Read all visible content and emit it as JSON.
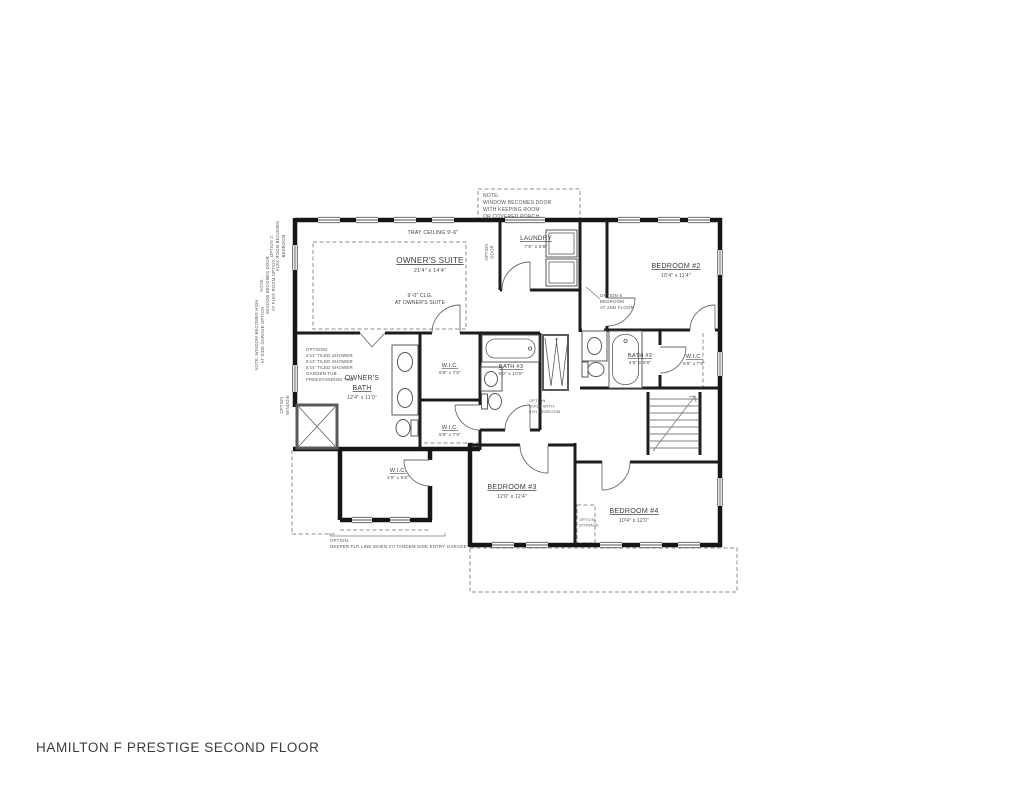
{
  "title": "HAMILTON F PRESTIGE SECOND FLOOR",
  "colors": {
    "wall": "#161616",
    "dashed": "#8f8f8f",
    "text": "#3d3d3d"
  },
  "plan": {
    "top_note": {
      "l1": "NOTE:",
      "l2": "WINDOW BECOMES DOOR",
      "l3": "WITH KEEPING ROOM",
      "l4": "OR COVERED PORCH"
    },
    "tray_ceiling": "TRAY CEILING 9'-6\"",
    "owners_suite": {
      "name": "OWNER'S SUITE",
      "dims": "21'4\" x 14'4\""
    },
    "clg_note": {
      "l1": "9'-0\" CLG.",
      "l2": "AT OWNER'S SUITE"
    },
    "laundry": {
      "name": "LAUNDRY",
      "dims": "7'6\" x 5'8\""
    },
    "laundry_note": {
      "l1": "OPTION",
      "l2": "DOOR"
    },
    "bedroom2": {
      "name": "BEDROOM #2",
      "dims": "10'4\" x 11'4\""
    },
    "option_bed5": {
      "l1": "OPTION 5",
      "l2": "BEDROOM",
      "l3": "AT 2ND FLOOR"
    },
    "bath2": {
      "name": "BATH #2",
      "dims": "4'8\" x 9'8\""
    },
    "wic_bed2": {
      "name": "W.I.C.",
      "dims": "6'8\" x 7'8\""
    },
    "bath3": {
      "name": "BATH #3",
      "dims": "5'0\" x 10'0\""
    },
    "option_door": {
      "l1": "OPTION",
      "l2": "DOOR WITH",
      "l3": "5TH BEDROOM"
    },
    "wic_owner1": {
      "name": "W.I.C.",
      "dims": "6'8\" x 7'8\""
    },
    "wic_owner2": {
      "name": "W.I.C.",
      "dims": "5'8\" x 7'8\""
    },
    "owners_bath": {
      "name1": "OWNER'S",
      "name2": "BATH",
      "dims": "12'4\" x 11'0\""
    },
    "bath_options": {
      "l1": "OPTIONS:",
      "l2": "4'x3' TILED SHOWER",
      "l3": "5'x3' TILED SHOWER",
      "l4": "5'x4' TILED SHOWER",
      "l5": "GARDEN TUB",
      "l6": "FREESTANDING TUB"
    },
    "wic_bed3": {
      "name": "W.I.C.",
      "dims": "4'6\" x 5'8\""
    },
    "bedroom3": {
      "name": "BEDROOM #3",
      "dims": "12'0\" x 12'4\""
    },
    "bedroom4": {
      "name": "BEDROOM #4",
      "dims": "10'4\" x 12'0\""
    },
    "option_storage": {
      "l1": "OPTION",
      "l2": "STORAGE"
    },
    "option_garage": {
      "l1": "OPTION:",
      "l2": "DEEPER FLR LINE WHEN 2'0 TANDEM SIDE ENTRY GARAGE"
    },
    "left_note_top": {
      "l1": "OPTION 2:",
      "l2": "FLEX ROOM BECOMES",
      "l3": "BEDROOM"
    },
    "left_note_mid": {
      "l1": "NOTE:",
      "l2": "WINDOW BECOMES DOOR",
      "l3": "AT FLEX ROOM OPTION"
    },
    "left_note_low": {
      "l1": "NOTE: WINDOW BECOMES HIGH",
      "l2": "AT SIDE GARAGE OPTION"
    },
    "left_note_owner": {
      "l1": "OPTION",
      "l2": "WINDOW"
    }
  }
}
